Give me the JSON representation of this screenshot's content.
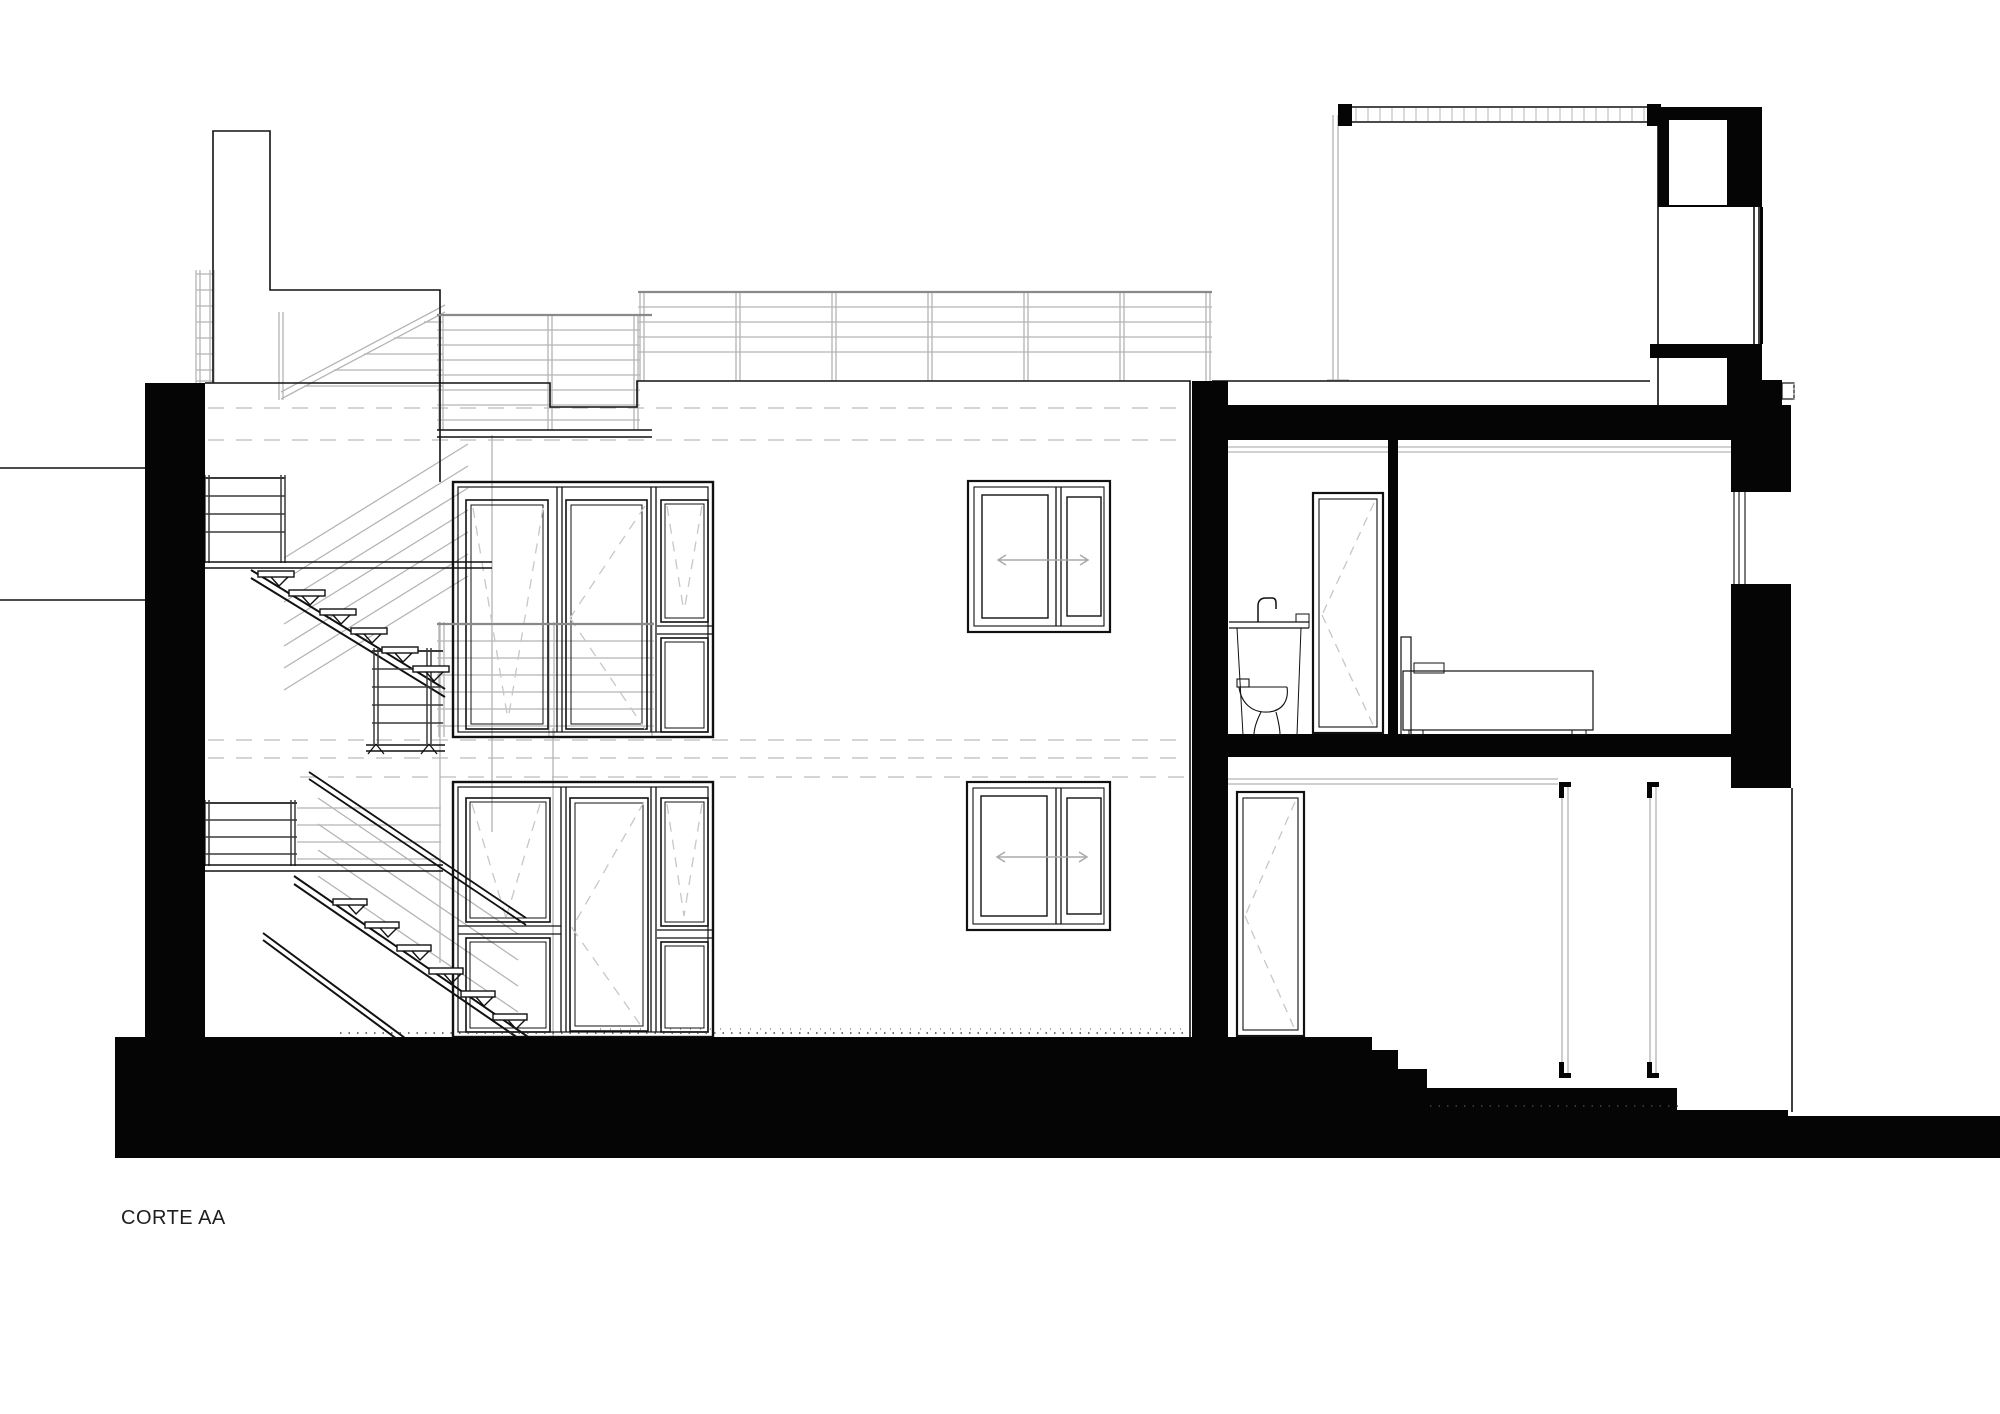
{
  "title": {
    "label": "CORTE AA"
  },
  "palette": {
    "ink": "#111111",
    "paper": "#ffffff",
    "cut_fill": "#050505",
    "light_line": "#b4b4b4",
    "dash_line": "#c7c7c7",
    "railing_dark": "#3a3a3a"
  },
  "drawing": {
    "type": "architectural-section",
    "label": "CORTE AA",
    "elements": [
      "chimney",
      "roof-guardrail",
      "balcony-railing",
      "exterior-stair",
      "upper-window-group",
      "lower-window-group",
      "sliding-window-upper",
      "sliding-window-lower",
      "section-cut-walls",
      "bathroom",
      "bedroom",
      "bed",
      "sink",
      "toilet",
      "bathroom-door",
      "ground-floor-door",
      "upper-volume-roof-deck",
      "glass-guard-panels",
      "stepped-ground"
    ]
  }
}
